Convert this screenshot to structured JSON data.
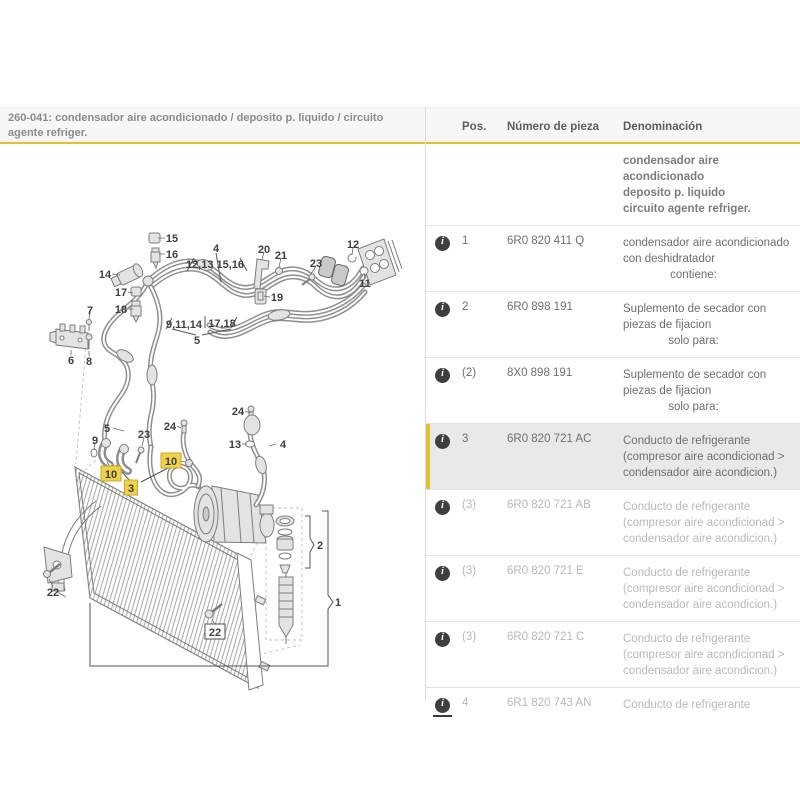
{
  "header": {
    "section_title": "260-041: condensador aire acondicionado / deposito p. liquido / circuito agente refriger."
  },
  "table": {
    "columns": [
      "Pos.",
      "Número de pieza",
      "Denominación"
    ],
    "rows": [
      {
        "intro": true,
        "bold": true,
        "icon": false,
        "pos": "",
        "number": "",
        "desc": [
          "condensador aire acondicionado",
          "deposito p. liquido",
          "circuito agente refriger."
        ]
      },
      {
        "icon": true,
        "pos": "1",
        "number": "6R0 820 411 Q",
        "desc": [
          "condensador aire acondicionado",
          "con deshidratador"
        ],
        "note": "contiene:"
      },
      {
        "icon": true,
        "pos": "2",
        "number": "6R0 898 191",
        "desc": [
          "Suplemento de secador con",
          "piezas de fijacion"
        ],
        "note": "solo para:"
      },
      {
        "icon": true,
        "pos": "(2)",
        "number": "8X0 898 191",
        "desc": [
          "Suplemento de secador con",
          "piezas de fijacion"
        ],
        "note": "solo para:"
      },
      {
        "icon": true,
        "highlighted": true,
        "pos": "3",
        "number": "6R0 820 721 AC",
        "desc": [
          "Conducto de refrigerante",
          "(compresor aire acondicionad >",
          "condensador aire acondicion.)"
        ]
      },
      {
        "icon": true,
        "dimmed": true,
        "pos": "(3)",
        "number": "6R0 820 721 AB",
        "desc": [
          "Conducto de refrigerante",
          "(compresor aire acondicionad >",
          "condensador aire acondicion.)"
        ]
      },
      {
        "icon": true,
        "dimmed": true,
        "pos": "(3)",
        "number": "6R0 820 721 E",
        "desc": [
          "Conducto de refrigerante",
          "(compresor aire acondicionad >",
          "condensador aire acondicion.)"
        ]
      },
      {
        "icon": true,
        "dimmed": true,
        "pos": "(3)",
        "number": "6R0 820 721 C",
        "desc": [
          "Conducto de refrigerante",
          "(compresor aire acondicionad >",
          "condensador aire acondicion.)"
        ]
      },
      {
        "icon": true,
        "dimmed": true,
        "last": true,
        "icon_underline": true,
        "pos": "4",
        "number": "6R1 820 743 AN",
        "desc": [
          "Conducto de refrigerante"
        ]
      }
    ]
  },
  "diagram": {
    "callouts": [
      {
        "label": "15",
        "x": 172,
        "y": 13,
        "style": "plain"
      },
      {
        "label": "16",
        "x": 172,
        "y": 29,
        "style": "plain"
      },
      {
        "label": "4",
        "x": 216,
        "y": 23,
        "style": "plain"
      },
      {
        "label": "12,13 15,16",
        "x": 215,
        "y": 39,
        "style": "plain"
      },
      {
        "label": "20",
        "x": 264,
        "y": 24,
        "style": "plain"
      },
      {
        "label": "21",
        "x": 281,
        "y": 30,
        "style": "plain"
      },
      {
        "label": "23",
        "x": 316,
        "y": 38,
        "style": "plain"
      },
      {
        "label": "12",
        "x": 353,
        "y": 19,
        "style": "plain"
      },
      {
        "label": "11",
        "x": 365,
        "y": 58,
        "style": "plain"
      },
      {
        "label": "14",
        "x": 105,
        "y": 49,
        "style": "plain"
      },
      {
        "label": "17",
        "x": 121,
        "y": 67,
        "style": "plain"
      },
      {
        "label": "18",
        "x": 121,
        "y": 84,
        "style": "plain"
      },
      {
        "label": "7",
        "x": 90,
        "y": 85,
        "style": "plain"
      },
      {
        "label": "6",
        "x": 71,
        "y": 135,
        "style": "plain"
      },
      {
        "label": "8",
        "x": 89,
        "y": 136,
        "style": "plain"
      },
      {
        "label": "9,11,14",
        "x": 184,
        "y": 99,
        "style": "plain"
      },
      {
        "label": "17,18",
        "x": 222,
        "y": 98,
        "style": "plain"
      },
      {
        "label": "5",
        "x": 197,
        "y": 115,
        "style": "plain"
      },
      {
        "label": "19",
        "x": 277,
        "y": 72,
        "style": "plain"
      },
      {
        "label": "5",
        "x": 107,
        "y": 203,
        "style": "plain"
      },
      {
        "label": "9",
        "x": 95,
        "y": 215,
        "style": "plain"
      },
      {
        "label": "23",
        "x": 144,
        "y": 209,
        "style": "plain"
      },
      {
        "label": "24",
        "x": 170,
        "y": 201,
        "style": "plain"
      },
      {
        "label": "24",
        "x": 238,
        "y": 186,
        "style": "plain"
      },
      {
        "label": "13",
        "x": 235,
        "y": 219,
        "style": "plain"
      },
      {
        "label": "4",
        "x": 283,
        "y": 219,
        "style": "plain"
      },
      {
        "label": "2",
        "x": 320,
        "y": 320,
        "style": "plain"
      },
      {
        "label": "1",
        "x": 338,
        "y": 377,
        "style": "plain"
      },
      {
        "label": "22",
        "x": 53,
        "y": 367,
        "style": "plain"
      },
      {
        "label": "10",
        "x": 111,
        "y": 249,
        "style": "highlight"
      },
      {
        "label": "10",
        "x": 171,
        "y": 236,
        "style": "highlight"
      },
      {
        "label": "3",
        "x": 131,
        "y": 263,
        "style": "highlight"
      },
      {
        "label": "22",
        "x": 215,
        "y": 407,
        "style": "boxed"
      }
    ]
  },
  "colors": {
    "accent_yellow": "#dfc22e",
    "callout_highlight": "#efd24b",
    "row_highlight": "#e9e9e9",
    "dimmed_text": "#b8b8b8",
    "info_icon_bg": "#3f3f3f"
  }
}
